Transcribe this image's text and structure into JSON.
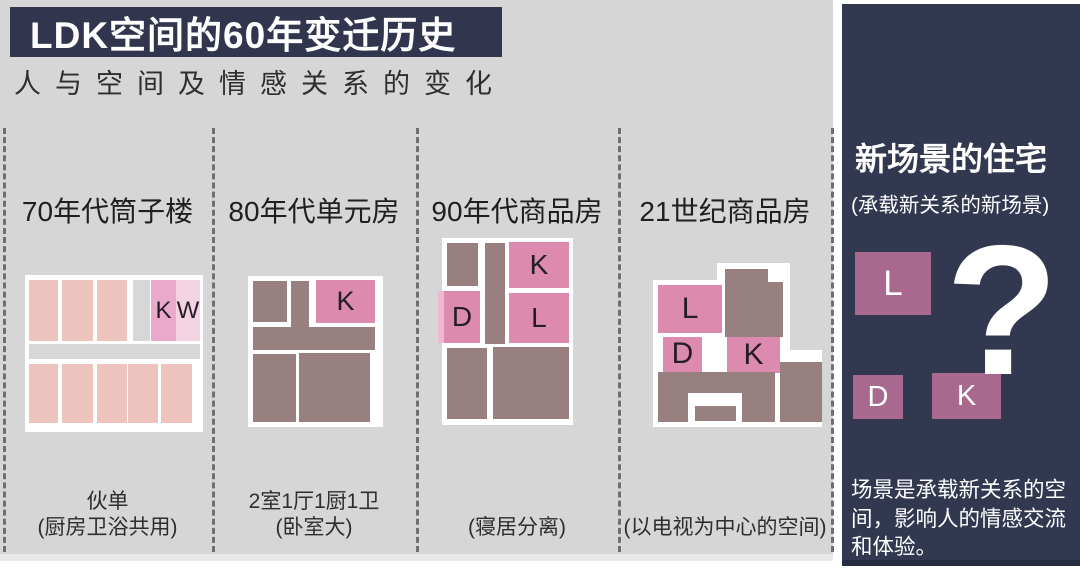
{
  "header": {
    "title": "LDK空间的60年变迁历史",
    "subtitle": "人与空间及情感关系的变化"
  },
  "palette": {
    "salmon": "#edc4bd",
    "grayCell": "#d8d7d7",
    "pinkK70": "#eaa8cb",
    "pinkW70": "#f3d3e1",
    "mauve": "#97807f",
    "pink": "#dc8aad",
    "pinkLight": "#f0b8ce",
    "white": "#ffffff",
    "panelBox": "#a9688e",
    "panelNavy": "#333851",
    "background": "#d7d6d6"
  },
  "columns": [
    {
      "heading": "70年代筒子楼",
      "caption_top": "伙单",
      "caption_bottom": "(厨房卫浴共用)",
      "plan": {
        "rooms": [
          {
            "l": 2.2,
            "t": 3.2,
            "w": 16.3,
            "h": 38.9,
            "c": "salmon"
          },
          {
            "l": 20.8,
            "t": 3.2,
            "w": 17.4,
            "h": 38.9,
            "c": "salmon"
          },
          {
            "l": 40.4,
            "t": 3.2,
            "w": 16.9,
            "h": 38.9,
            "c": "salmon"
          },
          {
            "l": 60.7,
            "t": 3.2,
            "w": 9.6,
            "h": 38.9,
            "c": "grayCell"
          },
          {
            "l": 70.8,
            "t": 3.2,
            "w": 14.0,
            "h": 38.9,
            "c": "pinkK70",
            "label": "K",
            "fs": 24
          },
          {
            "l": 84.8,
            "t": 3.2,
            "w": 13.5,
            "h": 38.9,
            "c": "pinkW70",
            "label": "W",
            "fs": 24
          },
          {
            "l": 2.2,
            "t": 43.9,
            "w": 96.1,
            "h": 9.6,
            "c": "grayCell"
          },
          {
            "l": 2.2,
            "t": 56.7,
            "w": 16.3,
            "h": 37.6,
            "c": "salmon"
          },
          {
            "l": 20.8,
            "t": 56.7,
            "w": 17.4,
            "h": 37.6,
            "c": "salmon"
          },
          {
            "l": 40.4,
            "t": 56.7,
            "w": 16.9,
            "h": 37.6,
            "c": "salmon"
          },
          {
            "l": 57.9,
            "t": 56.7,
            "w": 16.9,
            "h": 37.6,
            "c": "salmon"
          },
          {
            "l": 76.4,
            "t": 56.7,
            "w": 17.4,
            "h": 37.6,
            "c": "salmon"
          }
        ]
      }
    },
    {
      "heading": "80年代单元房",
      "caption_top": "2室1厅1厨1卫",
      "caption_bottom": "(卧室大)",
      "plan": {
        "rooms": [
          {
            "l": 3.7,
            "t": 3.3,
            "w": 25.2,
            "h": 27.2,
            "c": "mauve"
          },
          {
            "l": 31.9,
            "t": 3.3,
            "w": 13.3,
            "h": 45.7,
            "c": "mauve"
          },
          {
            "l": 50.4,
            "t": 2.6,
            "w": 43.7,
            "h": 28.5,
            "c": "pink",
            "label": "K",
            "fs": 27
          },
          {
            "l": 3.7,
            "t": 33.8,
            "w": 90.4,
            "h": 15.2,
            "c": "mauve"
          },
          {
            "l": 3.7,
            "t": 51.7,
            "w": 31.9,
            "h": 45.0,
            "c": "mauve"
          },
          {
            "l": 37.8,
            "t": 51.0,
            "w": 52.6,
            "h": 45.7,
            "c": "mauve"
          }
        ]
      }
    },
    {
      "heading": "90年代商品房",
      "caption_top": "",
      "caption_bottom": "(寝居分离)",
      "plan": {
        "rooms": [
          {
            "l": 3.8,
            "t": 2.7,
            "w": 23.7,
            "h": 23.0,
            "c": "mauve"
          },
          {
            "l": 32.8,
            "t": 2.7,
            "w": 15.3,
            "h": 54.0,
            "c": "mauve"
          },
          {
            "l": 51.1,
            "t": 2.1,
            "w": 45.8,
            "h": 24.6,
            "c": "pink",
            "label": "K",
            "fs": 28
          },
          {
            "l": 51.1,
            "t": 29.4,
            "w": 45.8,
            "h": 26.7,
            "c": "pink",
            "label": "L",
            "fs": 28
          },
          {
            "l": -3.1,
            "t": 28.3,
            "w": 4.8,
            "h": 27.8,
            "c": "pinkLight"
          },
          {
            "l": 1.5,
            "t": 28.3,
            "w": 27.5,
            "h": 27.8,
            "c": "pink",
            "label": "D",
            "fs": 28
          },
          {
            "l": 3.8,
            "t": 58.8,
            "w": 30.5,
            "h": 38.0,
            "c": "mauve"
          },
          {
            "l": 38.9,
            "t": 58.3,
            "w": 58.0,
            "h": 38.5,
            "c": "mauve"
          }
        ]
      }
    },
    {
      "heading": "21世纪商品房",
      "caption_top": "",
      "caption_bottom": "(以电视为中心的空间)",
      "plan": {
        "rooms": [
          {
            "l": 38.0,
            "t": 0,
            "w": 43.0,
            "h": 100,
            "c": "white"
          },
          {
            "l": 0,
            "t": 10.4,
            "w": 80.0,
            "h": 89.6,
            "c": "white"
          },
          {
            "l": 70.0,
            "t": 53.0,
            "w": 30.0,
            "h": 47.0,
            "c": "white"
          },
          {
            "l": 42.6,
            "t": 3.7,
            "w": 25.4,
            "h": 41.5,
            "c": "mauve"
          },
          {
            "l": 68.0,
            "t": 11.6,
            "w": 8.9,
            "h": 33.5,
            "c": "mauve"
          },
          {
            "l": 3.0,
            "t": 13.4,
            "w": 37.9,
            "h": 29.3,
            "c": "pink",
            "label": "L",
            "fs": 30
          },
          {
            "l": 5.9,
            "t": 45.1,
            "w": 23.1,
            "h": 21.3,
            "c": "pink",
            "label": "D",
            "fs": 30
          },
          {
            "l": 43.8,
            "t": 45.1,
            "w": 31.4,
            "h": 22.0,
            "c": "pink",
            "label": "K",
            "fs": 30
          },
          {
            "l": 75.1,
            "t": 60.4,
            "w": 24.9,
            "h": 36.6,
            "c": "mauve"
          },
          {
            "l": 3.0,
            "t": 66.5,
            "w": 69.2,
            "h": 30.5,
            "c": "mauve"
          },
          {
            "l": 20.7,
            "t": 79.3,
            "w": 32.0,
            "h": 20.7,
            "c": "white"
          },
          {
            "l": 24.9,
            "t": 87.2,
            "w": 24.3,
            "h": 9.1,
            "c": "mauve"
          }
        ]
      }
    }
  ],
  "panel": {
    "title": "新场景的住宅",
    "subtitle": "(承载新关系的新场景)",
    "question_mark": "?",
    "boxes": [
      {
        "label": "L"
      },
      {
        "label": "D"
      },
      {
        "label": "K"
      }
    ],
    "body": "场景是承载新关系的空间，影响人的情感交流和体验。"
  }
}
